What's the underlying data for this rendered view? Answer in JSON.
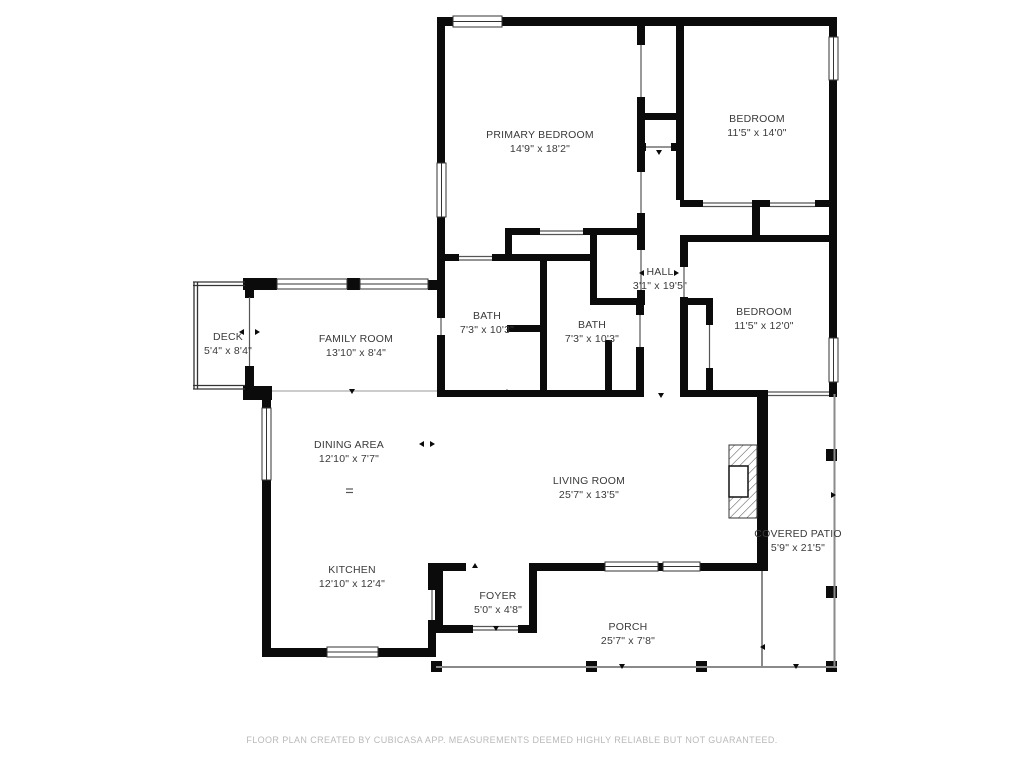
{
  "title": "Floor plan",
  "colors": {
    "wall": "#0b0b0b",
    "label_text": "#3a3a3a",
    "outdoor_line": "#8a8a8a",
    "window_line": "#333333",
    "footer_text": "#b9b9b9",
    "background": "#ffffff"
  },
  "rooms": [
    {
      "id": "primary-bedroom",
      "name": "PRIMARY BEDROOM",
      "dims": "14'9\" x 18'2\""
    },
    {
      "id": "bedroom-top-right",
      "name": "BEDROOM",
      "dims": "11'5\" x 14'0\""
    },
    {
      "id": "hall",
      "name": "HALL",
      "dims": "3'1\" x 19'5\""
    },
    {
      "id": "bedroom-right",
      "name": "BEDROOM",
      "dims": "11'5\" x 12'0\""
    },
    {
      "id": "bath-left",
      "name": "BATH",
      "dims": "7'3\" x 10'3\""
    },
    {
      "id": "bath-right",
      "name": "BATH",
      "dims": "7'3\" x 10'3\""
    },
    {
      "id": "deck",
      "name": "DECK",
      "dims": "5'4\" x 8'4\""
    },
    {
      "id": "family-room",
      "name": "FAMILY ROOM",
      "dims": "13'10\" x 8'4\""
    },
    {
      "id": "dining-area",
      "name": "DINING AREA",
      "dims": "12'10\" x 7'7\""
    },
    {
      "id": "living-room",
      "name": "LIVING ROOM",
      "dims": "25'7\" x 13'5\""
    },
    {
      "id": "kitchen",
      "name": "KITCHEN",
      "dims": "12'10\" x 12'4\""
    },
    {
      "id": "foyer",
      "name": "FOYER",
      "dims": "5'0\" x 4'8\""
    },
    {
      "id": "porch",
      "name": "PORCH",
      "dims": "25'7\" x 7'8\""
    },
    {
      "id": "covered-patio",
      "name": "COVERED PATIO",
      "dims": "5'9\" x 21'5\""
    }
  ],
  "footer": {
    "disclaimer": "FLOOR PLAN CREATED BY CUBICASA APP. MEASUREMENTS DEEMED HIGHLY RELIABLE BUT NOT GUARANTEED."
  }
}
